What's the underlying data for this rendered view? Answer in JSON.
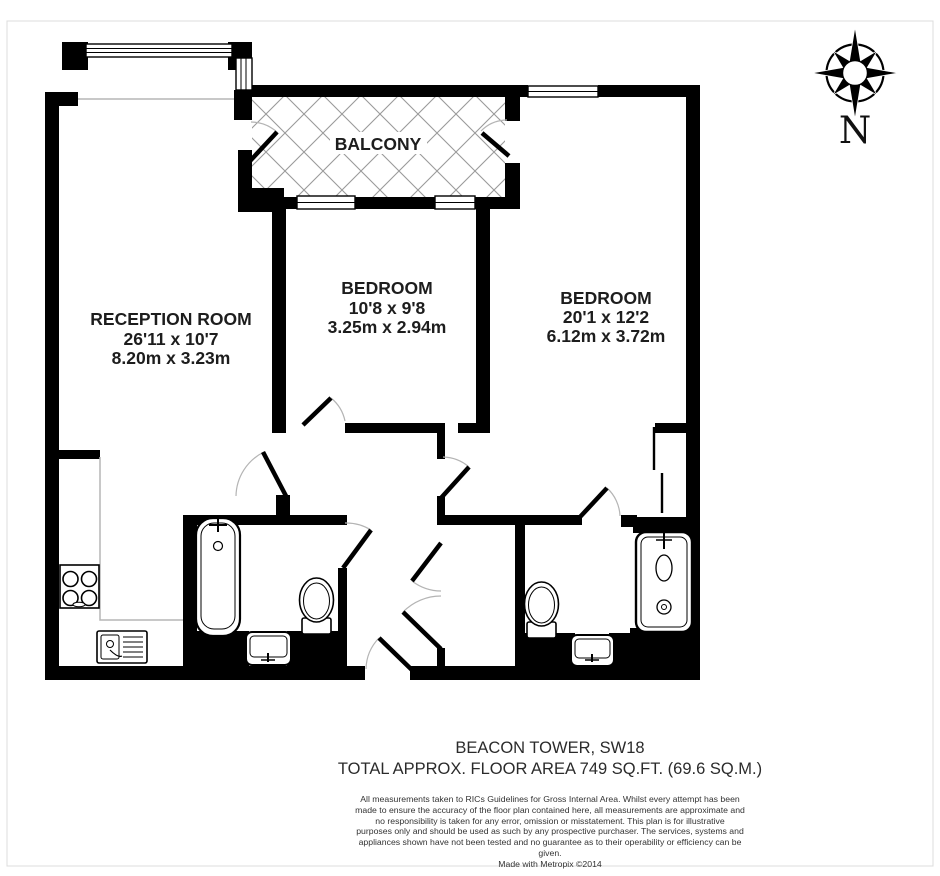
{
  "plan": {
    "rooms": [
      {
        "name": "BALCONY",
        "imperial": "",
        "metric": ""
      },
      {
        "name": "RECEPTION ROOM",
        "imperial": "26'11 x 10'7",
        "metric": "8.20m x 3.23m"
      },
      {
        "name": "BEDROOM",
        "imperial": "10'8 x 9'8",
        "metric": "3.25m x 2.94m"
      },
      {
        "name": "BEDROOM",
        "imperial": "20'1 x 12'2",
        "metric": "6.12m x 3.72m"
      }
    ],
    "compass": {
      "label": "N"
    },
    "footer": {
      "building": "BEACON TOWER, SW18",
      "area": "TOTAL APPROX. FLOOR AREA 749 SQ.FT. (69.6 SQ.M.)",
      "disclaimer_lines": [
        "All measurements taken to RICs Guidelines for Gross Internal Area. Whilst every attempt has been",
        "made to ensure the accuracy of the floor plan contained here, all measurements are approximate and",
        "no responsibility is taken for any error, omission or misstatement. This plan is for illustrative",
        "purposes only and should be used as such by any prospective purchaser. The services, systems and",
        "appliances shown have not been tested and no guarantee as to their operability or efficiency can be",
        "given."
      ],
      "credit": "Made with Metropix ©2014"
    },
    "colors": {
      "wall": "#000000",
      "hatch_line": "#9a9a9a",
      "door_arc": "#b4b4b4",
      "text": "#1d1d1d",
      "frame": "#dcdcdc"
    }
  }
}
